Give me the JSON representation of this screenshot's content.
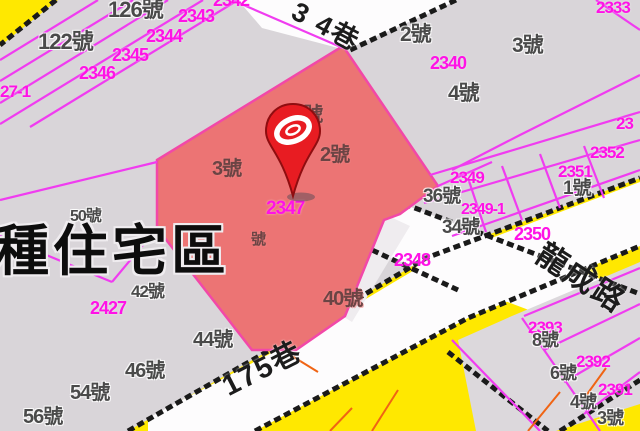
{
  "map": {
    "zone_label": "種住宅區",
    "selected_parcel_number": "2347",
    "pin": {
      "description": "red-map-pin-with-white-ring-logo"
    },
    "colors": {
      "background": "#d9d5d9",
      "parcel_line": "#f03cf0",
      "selected_parcel_fill": "#ec7474",
      "selected_parcel_edge": "#f248a8",
      "road_fill": "#ffffff",
      "road_zone_yellow": "#ffe800",
      "road_edge_black": "#1a1a1a",
      "orange_line": "#f06414",
      "parcel_number_text": "#ff12e6",
      "house_number_text": "#4a4a4a",
      "pin_red": "#e81c22"
    },
    "road_names": [
      {
        "t": "3 4巷",
        "x": 300,
        "y": -2,
        "s": 27,
        "r": 28
      },
      {
        "t": "175巷",
        "x": 218,
        "y": 376,
        "s": 29,
        "r": -27
      },
      {
        "t": "龍成路",
        "x": 548,
        "y": 238,
        "s": 31,
        "r": 33
      }
    ],
    "parcel_numbers": [
      {
        "t": "2342",
        "x": 213,
        "y": -9,
        "s": 18
      },
      {
        "t": "2343",
        "x": 178,
        "y": 7,
        "s": 18
      },
      {
        "t": "2344",
        "x": 146,
        "y": 27,
        "s": 18
      },
      {
        "t": "2345",
        "x": 112,
        "y": 46,
        "s": 18
      },
      {
        "t": "2346",
        "x": 79,
        "y": 64,
        "s": 18
      },
      {
        "t": "2333",
        "x": 596,
        "y": -1,
        "s": 17
      },
      {
        "t": "27-1",
        "x": 0,
        "y": 83,
        "s": 17
      },
      {
        "t": "2340",
        "x": 430,
        "y": 54,
        "s": 18
      },
      {
        "t": "23",
        "x": 616,
        "y": 115,
        "s": 17
      },
      {
        "t": "2352",
        "x": 590,
        "y": 144,
        "s": 17
      },
      {
        "t": "2351",
        "x": 558,
        "y": 163,
        "s": 17
      },
      {
        "t": "2349",
        "x": 450,
        "y": 169,
        "s": 17
      },
      {
        "t": "2349-1",
        "x": 461,
        "y": 202,
        "s": 16
      },
      {
        "t": "2350",
        "x": 514,
        "y": 225,
        "s": 18
      },
      {
        "t": "2347",
        "x": 266,
        "y": 199,
        "s": 19
      },
      {
        "t": "2348",
        "x": 394,
        "y": 251,
        "s": 18
      },
      {
        "t": "2427",
        "x": 90,
        "y": 299,
        "s": 18
      },
      {
        "t": "2393",
        "x": 528,
        "y": 319,
        "s": 17
      },
      {
        "t": "2392",
        "x": 576,
        "y": 353,
        "s": 17
      },
      {
        "t": "2391",
        "x": 598,
        "y": 381,
        "s": 17
      }
    ],
    "house_numbers": [
      {
        "t": "126號",
        "x": 108,
        "y": -1,
        "s": 22,
        "c": "hn"
      },
      {
        "t": "122號",
        "x": 38,
        "y": 31,
        "s": 22,
        "c": "hn"
      },
      {
        "t": "2號",
        "x": 400,
        "y": 24,
        "s": 21,
        "c": "hn"
      },
      {
        "t": "3號",
        "x": 512,
        "y": 35,
        "s": 21,
        "c": "hn"
      },
      {
        "t": "4號",
        "x": 448,
        "y": 83,
        "s": 21,
        "c": "hn"
      },
      {
        "t": "5號",
        "x": 293,
        "y": 105,
        "s": 20,
        "c": "hr"
      },
      {
        "t": "2號",
        "x": 320,
        "y": 145,
        "s": 20,
        "c": "hr"
      },
      {
        "t": "3號",
        "x": 212,
        "y": 159,
        "s": 20,
        "c": "hr"
      },
      {
        "t": "50號",
        "x": 70,
        "y": 209,
        "s": 16,
        "c": "hn"
      },
      {
        "t": "42號",
        "x": 131,
        "y": 283,
        "s": 17,
        "c": "hn"
      },
      {
        "t": "號",
        "x": 251,
        "y": 232,
        "s": 15,
        "c": "hr"
      },
      {
        "t": "36號",
        "x": 423,
        "y": 187,
        "s": 19,
        "c": "hn"
      },
      {
        "t": "34號",
        "x": 442,
        "y": 218,
        "s": 19,
        "c": "hn"
      },
      {
        "t": "1號",
        "x": 563,
        "y": 179,
        "s": 19,
        "c": "hn"
      },
      {
        "t": "40號",
        "x": 323,
        "y": 289,
        "s": 20,
        "c": "hr"
      },
      {
        "t": "44號",
        "x": 193,
        "y": 330,
        "s": 20,
        "c": "hn"
      },
      {
        "t": "46號",
        "x": 125,
        "y": 361,
        "s": 20,
        "c": "hn"
      },
      {
        "t": "54號",
        "x": 70,
        "y": 383,
        "s": 20,
        "c": "hn"
      },
      {
        "t": "56號",
        "x": 23,
        "y": 407,
        "s": 20,
        "c": "hn"
      },
      {
        "t": "8號",
        "x": 532,
        "y": 331,
        "s": 18,
        "c": "hn"
      },
      {
        "t": "6號",
        "x": 550,
        "y": 364,
        "s": 18,
        "c": "hn"
      },
      {
        "t": "4號",
        "x": 570,
        "y": 393,
        "s": 18,
        "c": "hn"
      },
      {
        "t": "3號",
        "x": 597,
        "y": 409,
        "s": 18,
        "c": "hn"
      }
    ]
  }
}
